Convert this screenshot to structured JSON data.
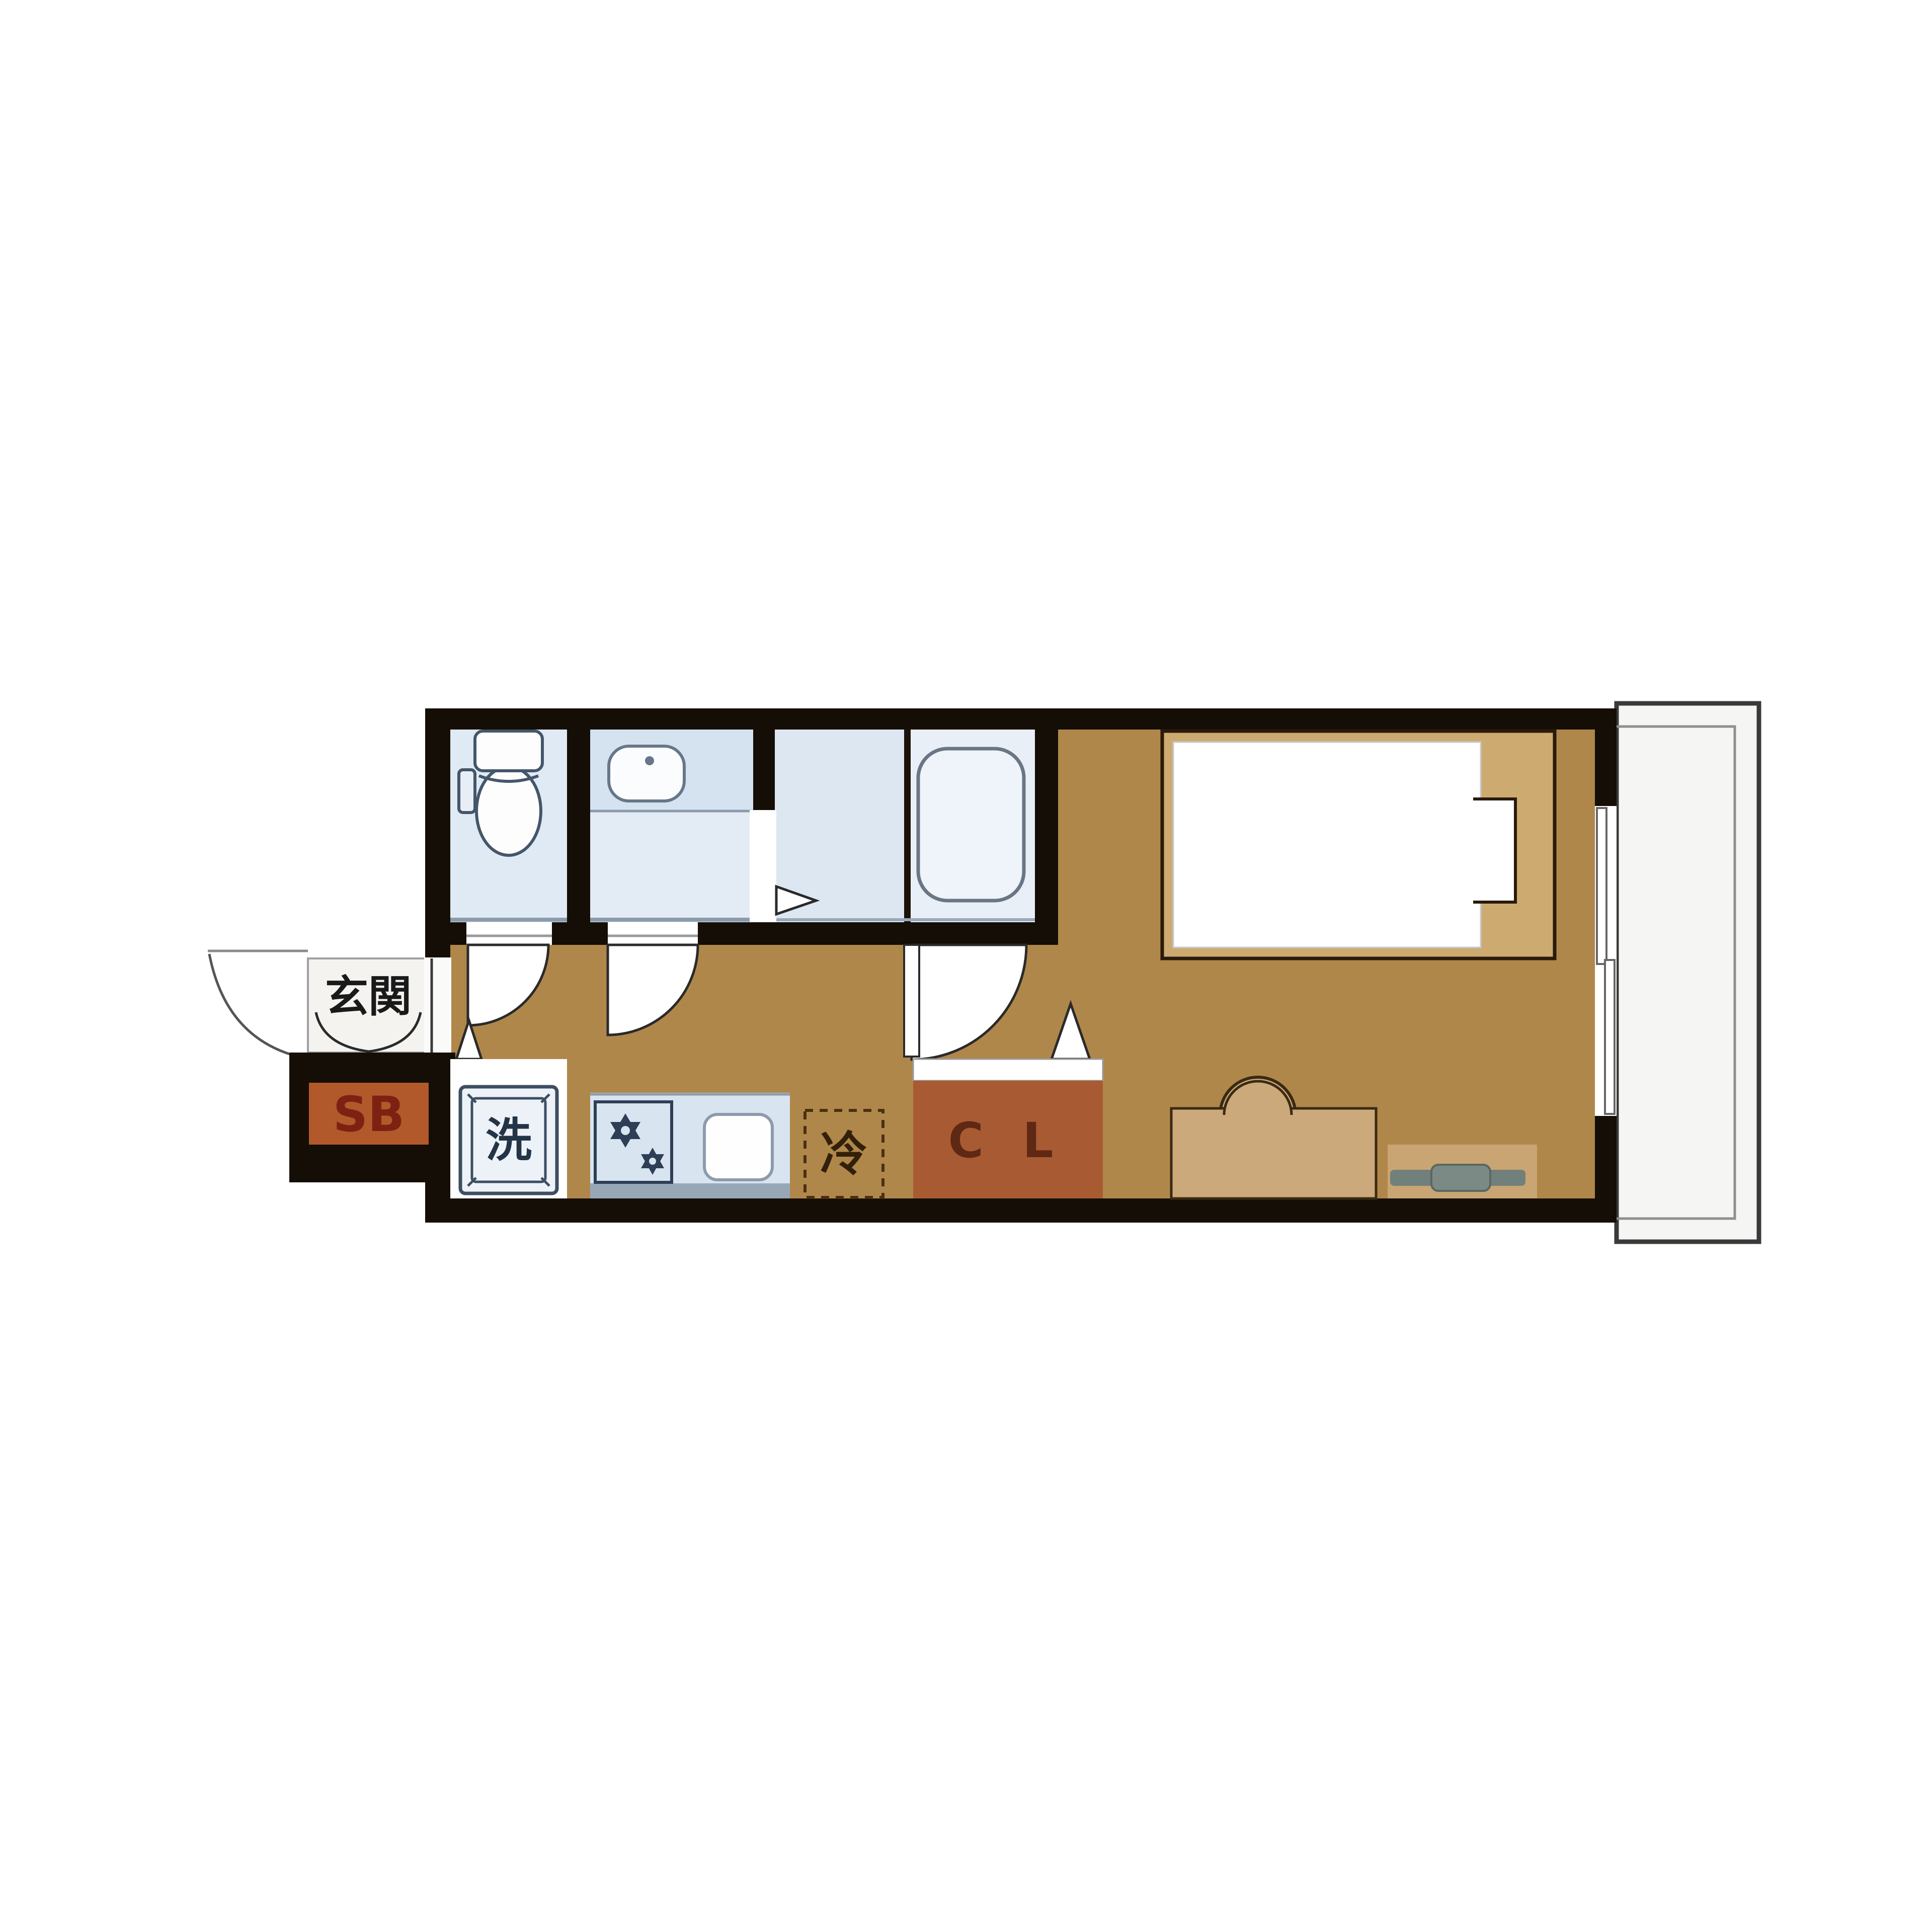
{
  "floor_plan": {
    "type": "japanese-apartment-1k-floor-plan",
    "labels": {
      "entrance": "玄関",
      "shoe_box": "SB",
      "washing_machine": "洗",
      "refrigerator": "冷",
      "closet": "C L"
    },
    "rooms": [
      "entrance (玄関)",
      "shoe box (SB)",
      "toilet",
      "washroom with basin",
      "bathroom with tub",
      "hallway kitchen",
      "refrigerator space (冷)",
      "closet (CL)",
      "main living room",
      "balcony"
    ],
    "fixtures": [
      "toilet-icon",
      "washbasin-icon",
      "bathtub-icon",
      "washing-machine-icon",
      "stove-burners-icon",
      "kitchen-sink-icon",
      "refrigerator-dashed-box",
      "bed-with-pillow",
      "desk-with-chair",
      "tv-on-board",
      "sliding-window",
      "door-swing-arcs"
    ],
    "colors": {
      "wall": "#150E06",
      "floor_brown": "#B0874A",
      "wet_room_blue": "#DFE9F4",
      "furniture_tan": "#CCAA75",
      "closet_brown": "#A85B32",
      "shoe_box_orange": "#B1592B",
      "fixture_stroke": "#44566A",
      "balcony_fill": "#F5F5F3",
      "tv_gray": "#72807B"
    }
  }
}
